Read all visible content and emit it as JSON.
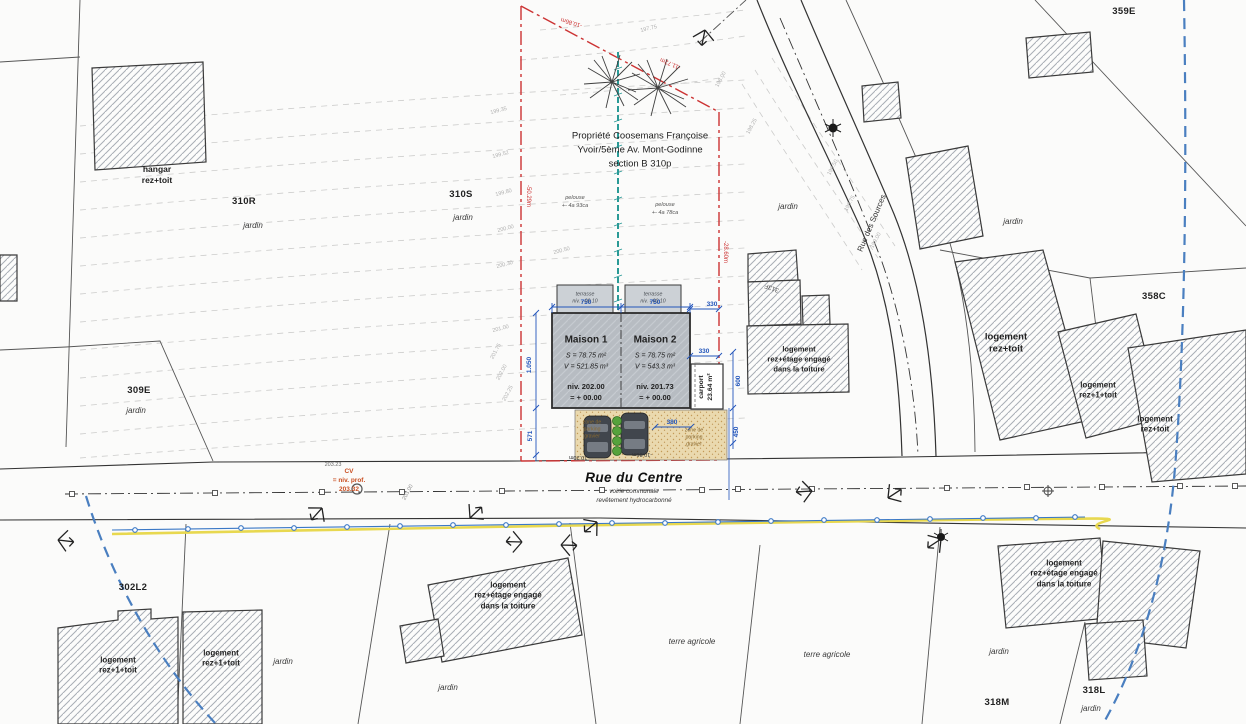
{
  "property_title": "Propriété Coosemans Françoise\nYvoir/5ème Av. Mont-Godinne\nsection B 310p",
  "streets": {
    "main": "Rue du Centre",
    "main_sub1": "voirie communale",
    "main_sub2": "revêtement hydrocarbonné",
    "side": "Rue des Sources"
  },
  "houses": {
    "maison1": {
      "name": "Maison 1",
      "metrics": "S = 78.75 m²\nV = 521.85 m³",
      "level": "niv. 202.00\n= + 00.00"
    },
    "maison2": {
      "name": "Maison 2",
      "metrics": "S = 78.75 m²\nV = 543.3 m³",
      "level": "niv. 201.73\n= + 00.00"
    },
    "terrace_label": "terrasse\nniv. - 00.10",
    "carport": "carport\n23.64 m²"
  },
  "lawn_left": "pelouse\n+- 4a 93ca",
  "lawn_right": "pelouse\n+- 4a 78ca",
  "parking_zone_label": "zone de\nparking\ngravier",
  "frontage": {
    "left": "-10.20m",
    "right": "-10.86m"
  },
  "boundary": {
    "left": "-50.29m",
    "top1": "-10.86m",
    "top2": "-11.72m",
    "right": "-28.60m"
  },
  "cv_note": "CV\n= niv. prof.\n203.32",
  "parcels": {
    "p310R": "310R",
    "p310S": "310S",
    "p309E": "309E",
    "p302L2": "302L2",
    "p359E": "359E",
    "p358C": "358C",
    "p318M": "318M",
    "p318L": "318L",
    "p313F": "313F"
  },
  "land_use": {
    "jardin": "jardin",
    "terre": "terre agricole"
  },
  "building_labels": {
    "hangar": "hangar\nrez+toit",
    "rez1": "logement\nrez+1+toit",
    "rez": "logement\nrez+toit",
    "rezetage": "logement\nrez+étage engagé\ndans la toiture"
  },
  "dims": {
    "d750": "750",
    "d330": "330",
    "d380": "380",
    "d1050": "1.050",
    "d571": "571",
    "d600": "600",
    "d450": "450"
  },
  "contours": [
    "197.75",
    "198.00",
    "198.25",
    "198.50",
    "198.75",
    "199.00",
    "199.35",
    "199.52",
    "199.80",
    "200.00",
    "200.30",
    "200.50",
    "201.00",
    "201.75",
    "202.00",
    "202.25",
    "203.00",
    "203.23"
  ],
  "colors": {
    "boundary_red": "#cc3333",
    "dim_blue": "#2255bb",
    "utility_blue": "#4a7fc0",
    "pipe_blue": "#3b78c6",
    "highlight_yellow": "#e8d84f",
    "divider_teal": "#2a9a96",
    "parking_tan": "#ead9ae",
    "house_gray": "#b7bcc2",
    "shrub_green": "#55a23c"
  }
}
